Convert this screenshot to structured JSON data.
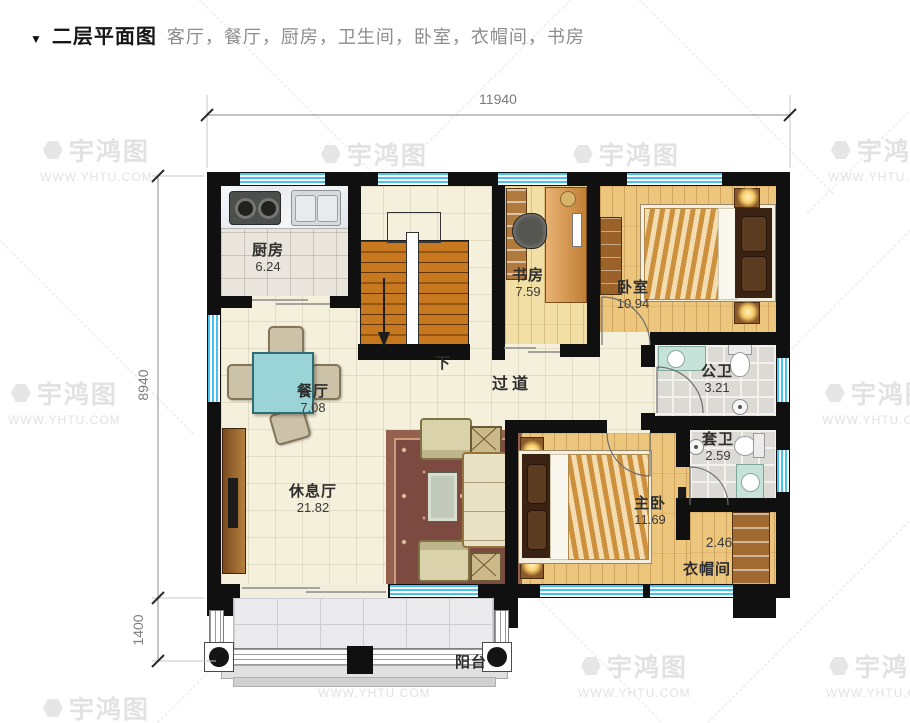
{
  "header": {
    "marker": "▼",
    "title": "二层平面图",
    "subtitle": "客厅，餐厅，厨房，卫生间，卧室，衣帽间，书房"
  },
  "dimensions": {
    "width_total": "11940",
    "height_main": "8940",
    "height_balcony": "1400"
  },
  "watermark": {
    "brand": "宇鸿图",
    "site": "WWW.YHTU.COM"
  },
  "rooms": {
    "kitchen": {
      "name": "厨房",
      "area": "6.24"
    },
    "study": {
      "name": "书房",
      "area": "7.59"
    },
    "bedroom": {
      "name": "卧室",
      "area": "10.94"
    },
    "public_bath": {
      "name": "公卫",
      "area": "3.21"
    },
    "ensuite": {
      "name": "套卫",
      "area": "2.59"
    },
    "dining": {
      "name": "餐厅",
      "area": "7.08"
    },
    "hallway": {
      "name": "过道"
    },
    "lounge": {
      "name": "休息厅",
      "area": "21.82"
    },
    "master_bedroom": {
      "name": "主卧",
      "area": "11.69"
    },
    "cloakroom": {
      "name": "衣帽间",
      "area": "2.46"
    },
    "balcony": {
      "name": "阳台"
    },
    "stairs": {
      "direction_label": "下"
    }
  },
  "colors": {
    "window_glass": "#49c3ee",
    "wall": "#101010",
    "stair_tread": "#c8791f",
    "rug": "#7d4a41",
    "cream_tile": "#f4f0dc",
    "wood_floor": "#edc67e"
  }
}
